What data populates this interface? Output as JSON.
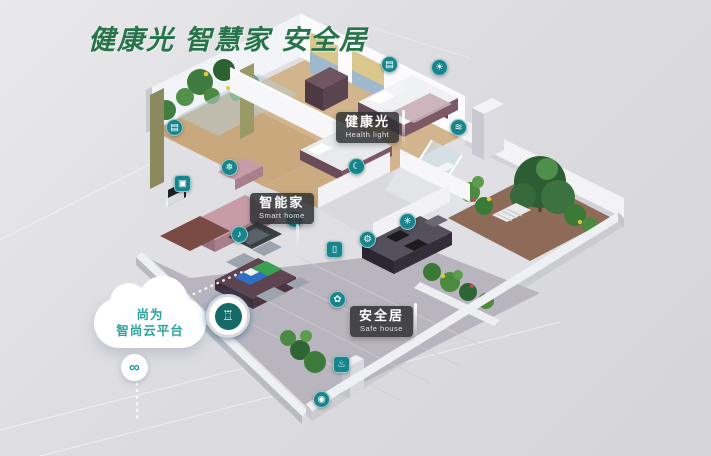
{
  "title": "健康光 智慧家 安全居",
  "cloud": {
    "name_line": "尚为",
    "platform_line": "智尚云平台"
  },
  "badges": {
    "health": {
      "zh": "健康光",
      "en": "Health light"
    },
    "smart": {
      "zh": "智能家",
      "en": "Smart home"
    },
    "safe": {
      "zh": "安全居",
      "en": "Safe house"
    }
  },
  "devices": {
    "curtain_living": "▤",
    "ac": "❄",
    "tv": "▣",
    "speaker": "♪",
    "curtain_bedroom": "▤",
    "ceiling_light": "☀",
    "sleep": "☾",
    "bath": "≋",
    "door_sensor": "◫",
    "wifi": "✳",
    "gear": "⚙",
    "window_sensor": "▯",
    "irrigation": "✿",
    "floor_heating": "♨",
    "doorbell": "◉",
    "hub": "♖",
    "cloud_link": "∞"
  },
  "colors": {
    "title_green": "#27744a",
    "device_teal": "#17858b",
    "cloud_text_teal": "#2aa39e",
    "badge_bg": "rgba(45,47,50,0.84)"
  }
}
